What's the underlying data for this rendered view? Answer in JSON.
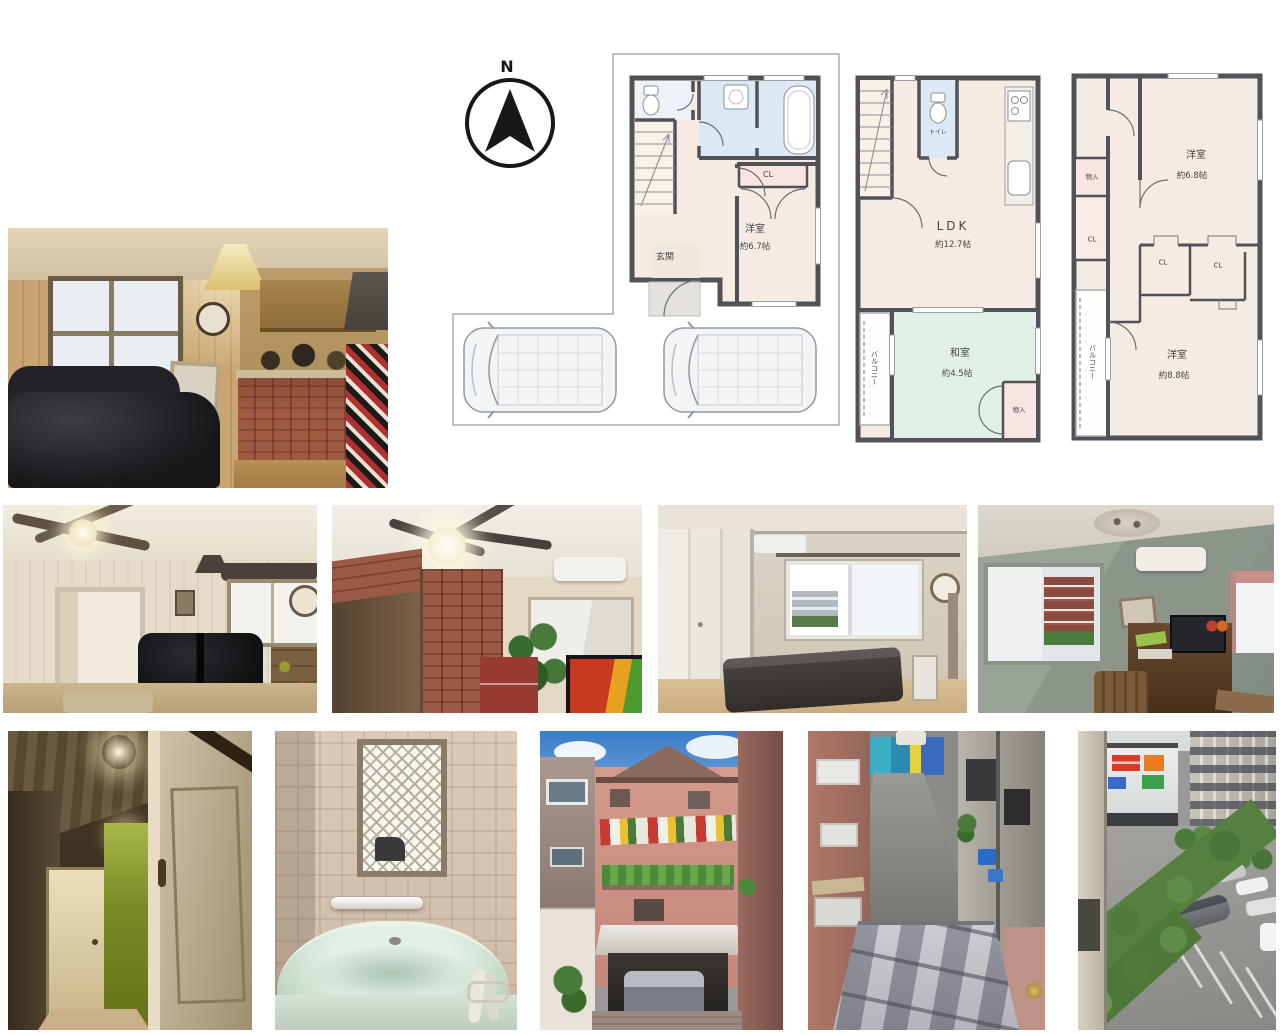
{
  "compass": {
    "label": "N"
  },
  "floorplans": {
    "f1": {
      "closet": "CL",
      "room_name": "洋室",
      "room_size": "約6.7帖",
      "entrance": "玄関"
    },
    "f2": {
      "toilet": "トイレ",
      "ldk_name": "LDK",
      "ldk_size": "約12.7帖",
      "balcony": "バルコニー",
      "washitsu_name": "和室",
      "washitsu_size": "約4.5帖",
      "storage": "物入"
    },
    "f3": {
      "room1_name": "洋室",
      "room1_size": "約6.8帖",
      "storage": "物入",
      "closet_left": "CL",
      "closet_mid": "CL",
      "closet_right": "CL",
      "balcony": "バルコニー",
      "room2_name": "洋室",
      "room2_size": "約8.8帖"
    }
  },
  "colors": {
    "wall": "#515257",
    "room_cream": "#f6ebe2",
    "room_blue": "#dce8f4",
    "room_green": "#e2f1e5",
    "room_pink": "#f8e5e2",
    "site_outline": "#a9adb3"
  }
}
